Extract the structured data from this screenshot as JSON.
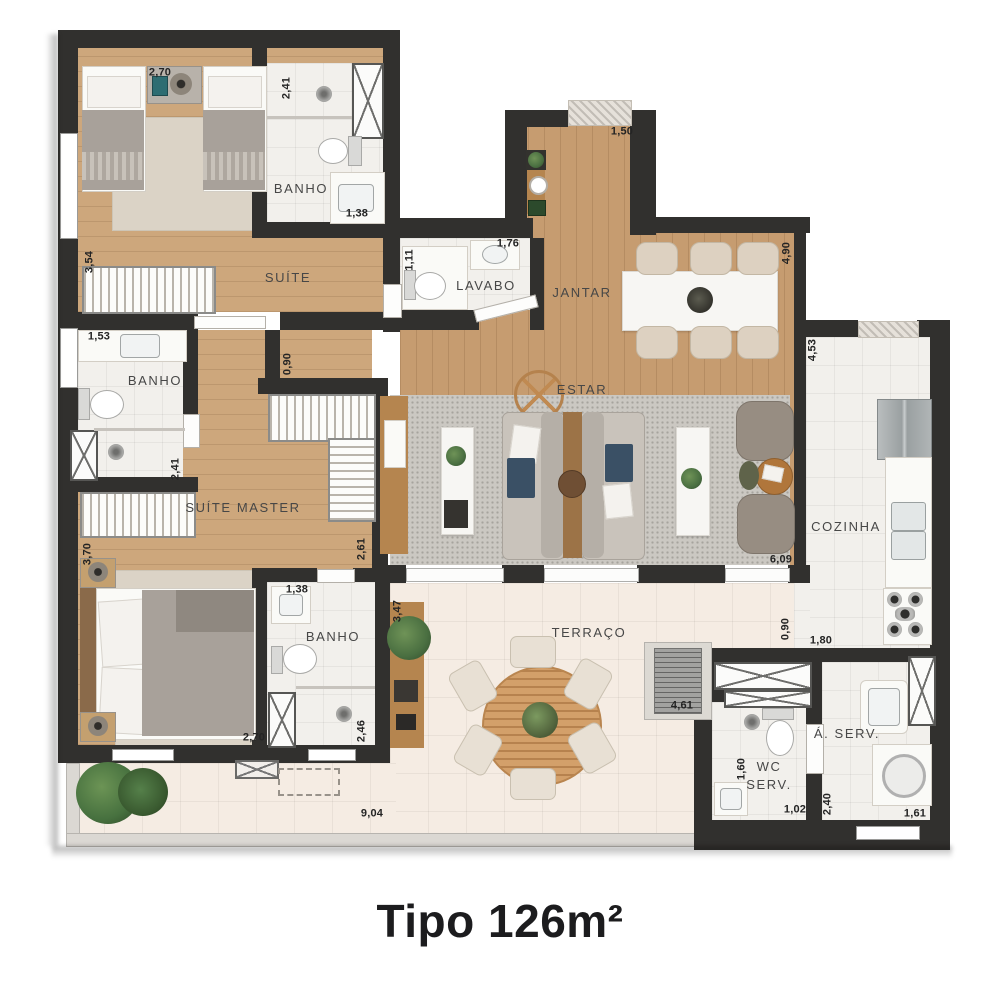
{
  "title": "Tipo 126m²",
  "rooms": {
    "suite": "SUÍTE",
    "banho_suite": "BANHO",
    "lavabo": "LAVABO",
    "jantar": "JANTAR",
    "estar": "ESTAR",
    "banho_master": "BANHO",
    "suite_master": "SUÍTE MASTER",
    "banho_2": "BANHO",
    "terraco": "TERRAÇO",
    "cozinha": "COZINHA",
    "wc_serv_1": "WC",
    "wc_serv_2": "SERV.",
    "a_serv": "Á. SERV."
  },
  "dims": {
    "suite_w": "2,70",
    "banho1_d": "2,41",
    "suite_l": "3,54",
    "banho1_w": "1,38",
    "lavabo_d": "1,11",
    "lavabo_w": "1,76",
    "entry_w": "1,50",
    "jantar_l": "4,90",
    "cozinha_l": "4,53",
    "banhom_w": "1,53",
    "master_door": "0,90",
    "banhom_d": "2,41",
    "master_l": "3,70",
    "closet_l": "2,61",
    "banho2_w": "1,38",
    "master_w": "2,70",
    "banho2_d": "2,46",
    "terraco_d": "3,47",
    "estar_w": "6,09",
    "terraco_w": "9,04",
    "terraco_r": "4,61",
    "coz_pass": "0,90",
    "aserv_top": "1,80",
    "wcserv_d": "1,60",
    "wcserv_w": "1,02",
    "aserv_d": "2,40",
    "aserv_w": "1,61"
  },
  "colors": {
    "wall": "#31302e",
    "wood": "#c69c70",
    "wood_light": "#cda77c",
    "tile": "#f2f0ec",
    "terrace": "#f5ece3",
    "rug": "#cbc8c2",
    "rug_beige": "#dbd3c6",
    "wood_furniture": "#b5854f",
    "marble": "#f7f6f3",
    "sofa": "#c9c3bb",
    "navy": "#3a5065",
    "blanket": "#a8a19a",
    "plant": "#4a6f41"
  }
}
